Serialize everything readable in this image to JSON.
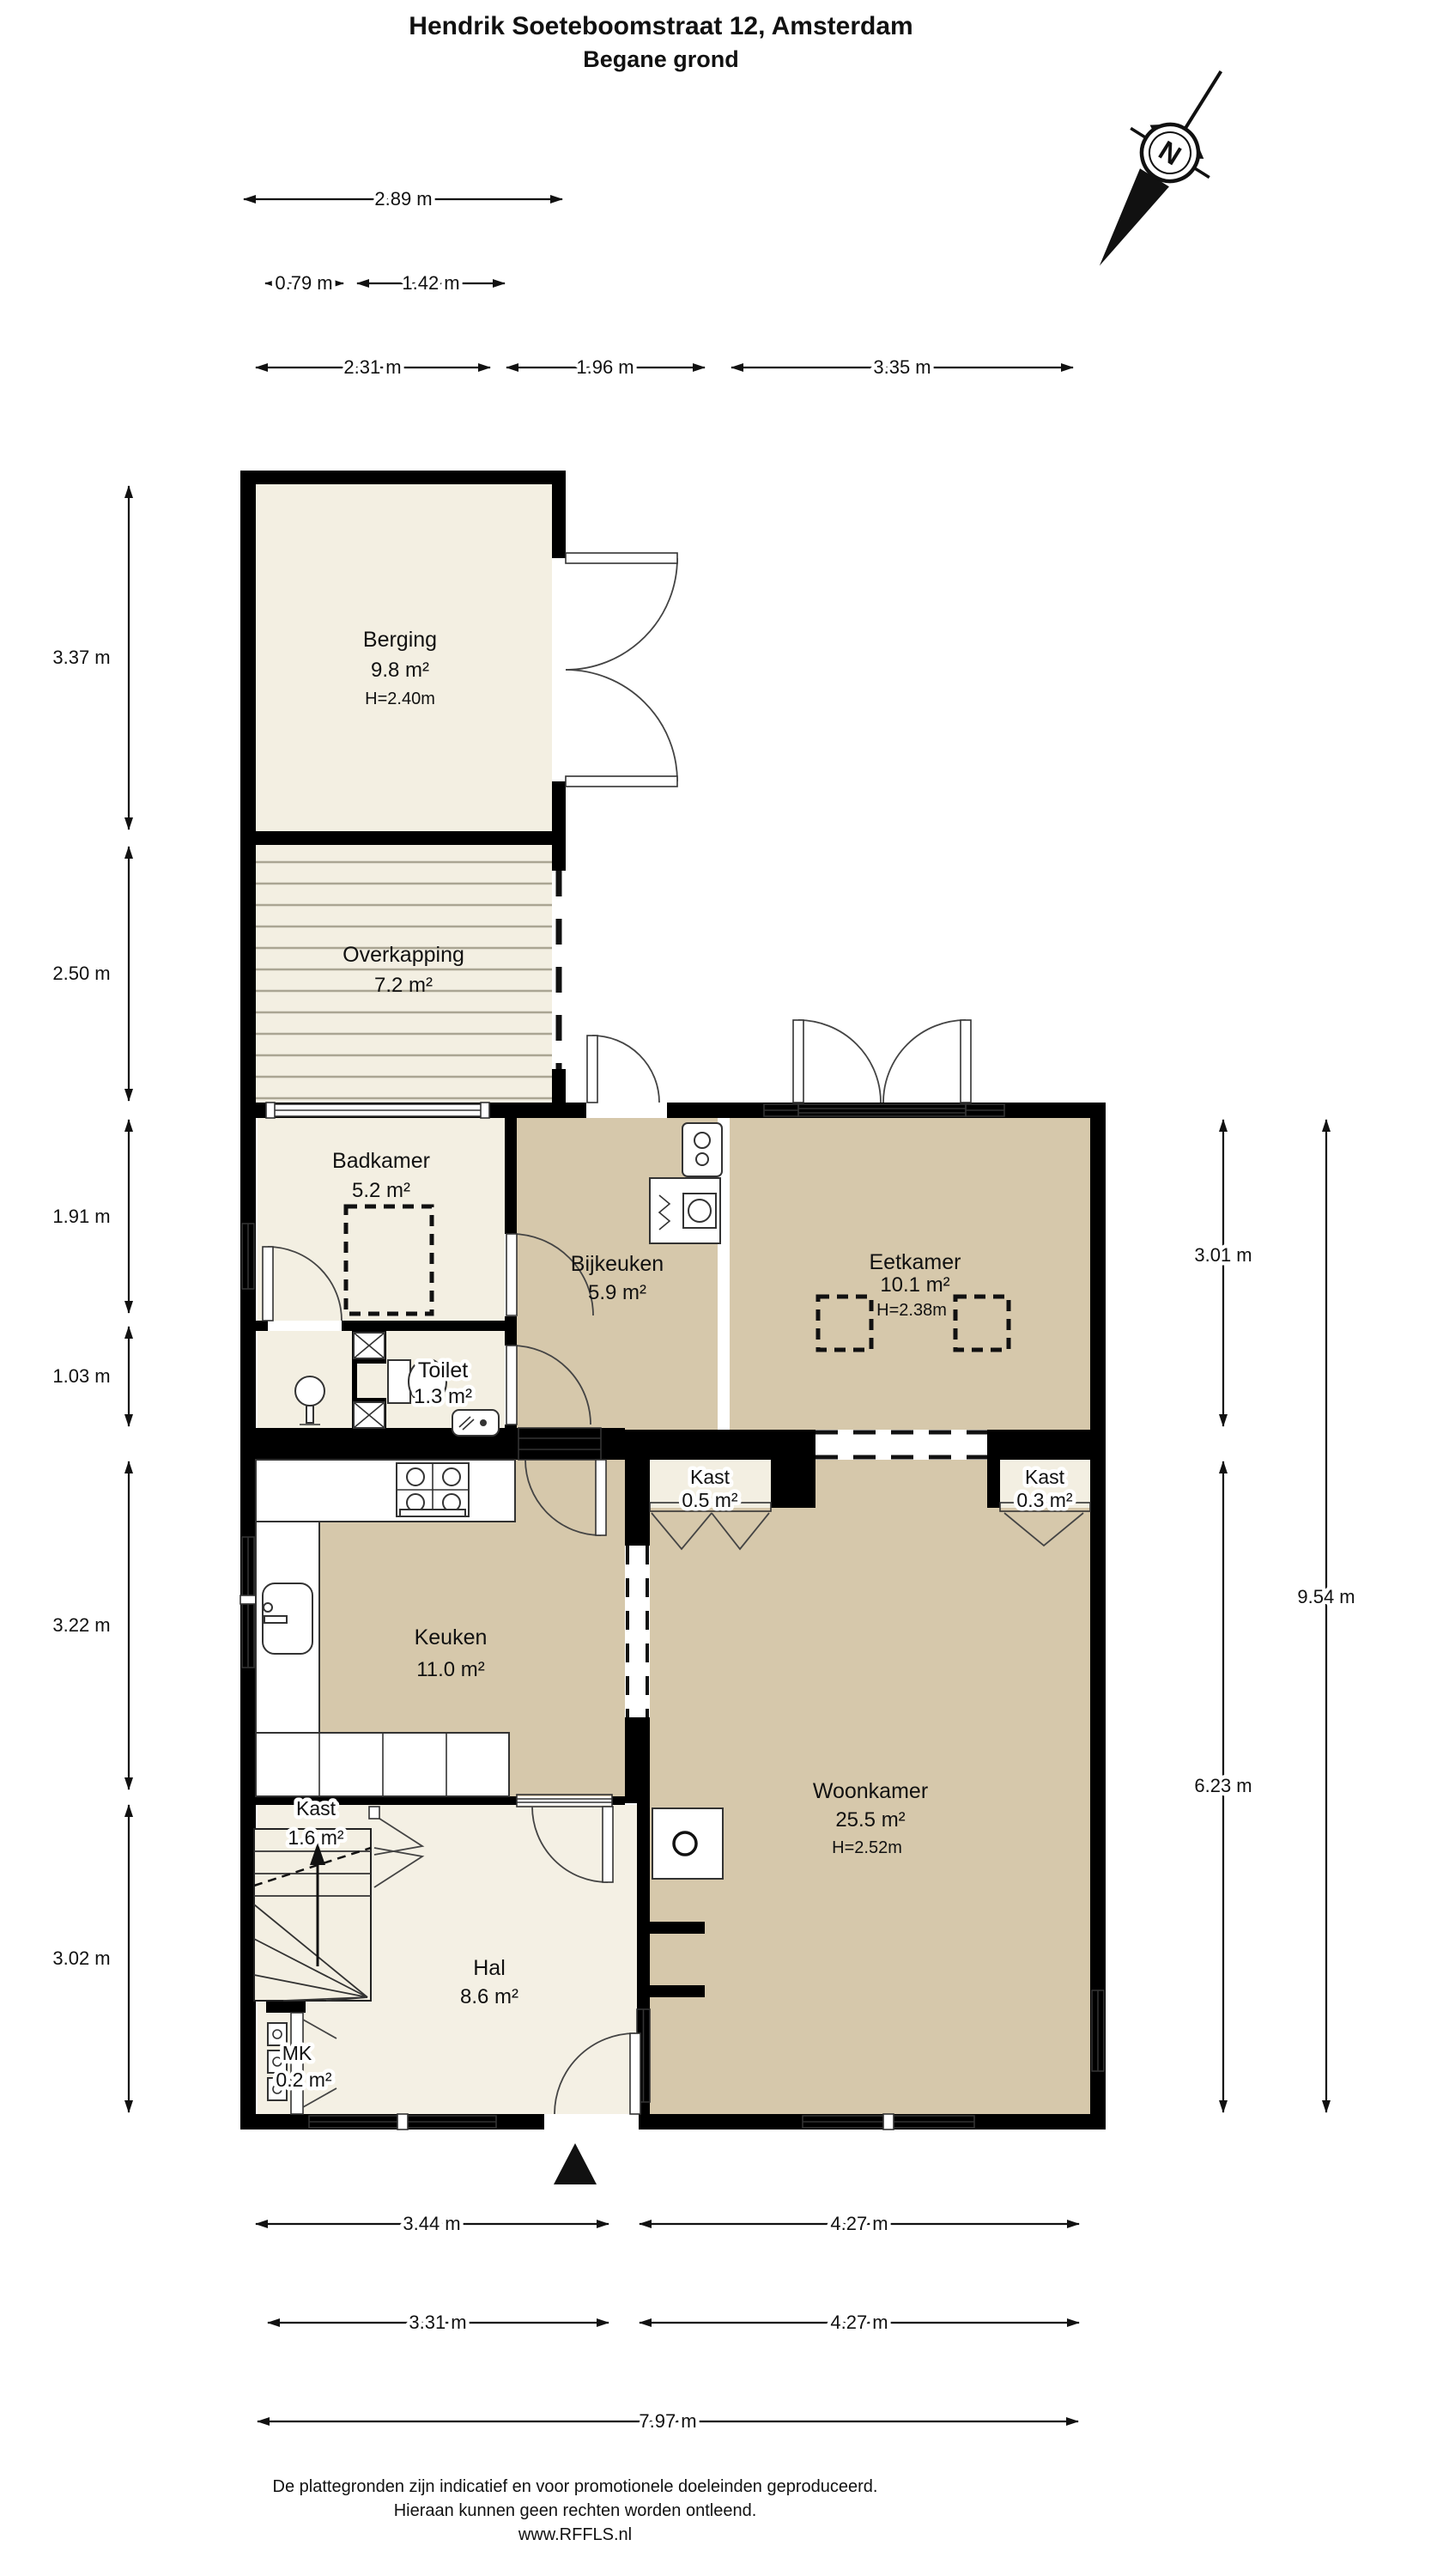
{
  "title": "Hendrik Soeteboomstraat 12, Amsterdam",
  "subtitle": "Begane grond",
  "compass": {
    "north_label": "N"
  },
  "rooms": {
    "berging": {
      "name": "Berging",
      "area": "9.8 m²",
      "ceiling": "H=2.40m"
    },
    "overkapping": {
      "name": "Overkapping",
      "area": "7.2 m²"
    },
    "badkamer": {
      "name": "Badkamer",
      "area": "5.2 m²"
    },
    "bijkeuken": {
      "name": "Bijkeuken",
      "area": "5.9 m²"
    },
    "toilet": {
      "name": "Toilet",
      "area": "1.3 m²"
    },
    "eetkamer": {
      "name": "Eetkamer",
      "area": "10.1 m²",
      "ceiling": "H=2.38m"
    },
    "keuken": {
      "name": "Keuken",
      "area": "11.0 m²"
    },
    "woonkamer": {
      "name": "Woonkamer",
      "area": "25.5 m²",
      "ceiling": "H=2.52m"
    },
    "hal": {
      "name": "Hal",
      "area": "8.6 m²"
    },
    "kast_keuken": {
      "name": "Kast",
      "area": "0.5 m²"
    },
    "kast_woonkamer": {
      "name": "Kast",
      "area": "0.3 m²"
    },
    "kast_trap": {
      "name": "Kast",
      "area": "1.6 m²"
    },
    "meterkast": {
      "name": "MK",
      "area": "0.2 m²"
    }
  },
  "dimensions": {
    "top": [
      "2.89 m",
      "0.79 m",
      "1.42 m",
      "2.31 m",
      "1.96 m",
      "3.35 m"
    ],
    "left": [
      "3.37 m",
      "2.50 m",
      "1.91 m",
      "1.03 m",
      "3.22 m",
      "3.02 m"
    ],
    "right": [
      "3.01 m",
      "6.23 m",
      "9.54 m"
    ],
    "bottom": [
      "3.44 m",
      "4.27 m",
      "3.31 m",
      "4.27 m",
      "7.97 m"
    ]
  },
  "footer": {
    "line1": "De plattegronden zijn indicatief en voor promotionele doeleinden geproduceerd.",
    "line2": "Hieraan kunnen geen rechten worden ontleend.",
    "line3": "www.RFFLS.nl"
  },
  "colors": {
    "floor_light": "#f3efe2",
    "floor_tan": "#d6c8ab",
    "wall": "#000000"
  }
}
